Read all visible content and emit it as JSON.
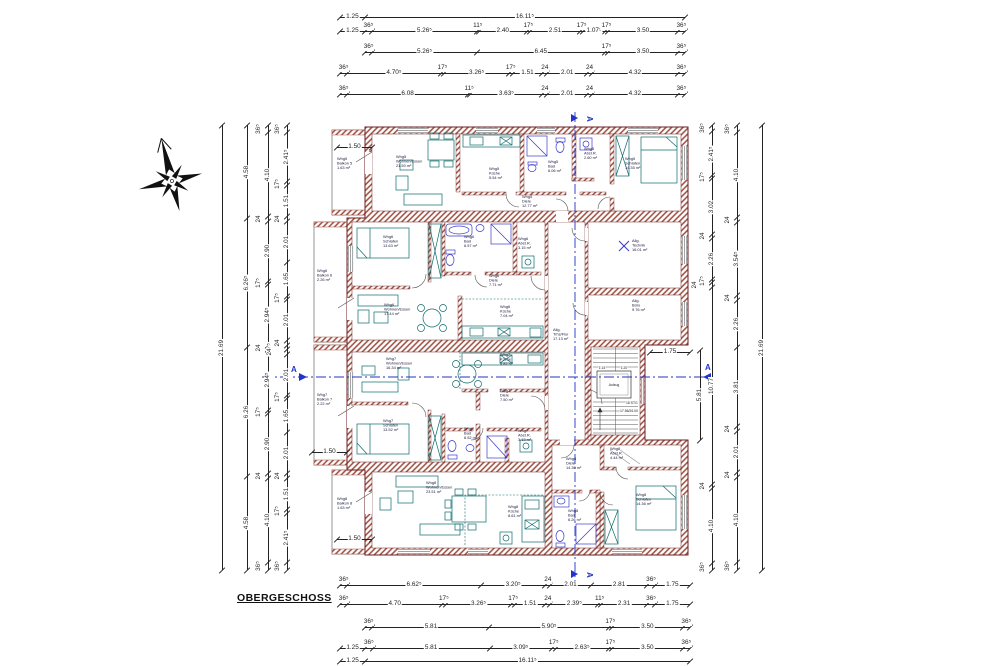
{
  "title": "OBERGESCHOSS",
  "palette": {
    "wall_hatch": "#9a4a3c",
    "wall_line": "#6e2222",
    "furniture": "#0e6b6b",
    "fixture": "#3a3ac8",
    "section": "#2233cc",
    "dim_text": "#1c1c1c",
    "background": "#ffffff"
  },
  "plan": {
    "section_marker": "A",
    "stair": {
      "elevator": "Aufzug",
      "steps": "18 STG",
      "step_dim": "17.56/26.00",
      "width_a": "1.14",
      "width_b": "1.20"
    },
    "rooms": [
      {
        "apt": "Whg5",
        "name": "Wohnen/Essen",
        "area": "21.50 m²"
      },
      {
        "apt": "Whg5",
        "name": "Küche",
        "area": "5.54 m²"
      },
      {
        "apt": "Whg5",
        "name": "Bad",
        "area": "6.06 m²"
      },
      {
        "apt": "Whg5",
        "name": "Abst.R.",
        "area": "2.60 m²"
      },
      {
        "apt": "Whg5",
        "name": "Schlafen",
        "area": "14.35 m²"
      },
      {
        "apt": "Whg5",
        "name": "Diele",
        "area": "12.77 m²"
      },
      {
        "apt": "Whg5",
        "name": "Balkon 5",
        "area": "1.63 m²"
      },
      {
        "apt": "Whg6",
        "name": "Schlafen",
        "area": "13.63 m²"
      },
      {
        "apt": "Whg6",
        "name": "Bad",
        "area": "6.57 m²"
      },
      {
        "apt": "Whg6",
        "name": "Abst.R.",
        "area": "3.15 m²"
      },
      {
        "apt": "Whg6",
        "name": "Diele",
        "area": "7.71 m²"
      },
      {
        "apt": "Whg6",
        "name": "Wohnen/Essen",
        "area": "17.44 m²"
      },
      {
        "apt": "Whg6",
        "name": "Küche",
        "area": "7.04 m²"
      },
      {
        "apt": "Whg6",
        "name": "Balkon 6",
        "area": "2.26 m²"
      },
      {
        "apt": "Whg7",
        "name": "Wohnen/Essen",
        "area": "16.34 m²"
      },
      {
        "apt": "Whg7",
        "name": "Küche",
        "area": "6.82 m²"
      },
      {
        "apt": "Whg7",
        "name": "Diele",
        "area": "7.50 m²"
      },
      {
        "apt": "Whg7",
        "name": "Schlafen",
        "area": "13.52 m²"
      },
      {
        "apt": "Whg7",
        "name": "Bad",
        "area": "6.52 m²"
      },
      {
        "apt": "Whg7",
        "name": "Abst.R.",
        "area": "3.13 m²"
      },
      {
        "apt": "Whg7",
        "name": "Balkon 7",
        "area": "2.22 m²"
      },
      {
        "apt": "Whg8",
        "name": "Wohnen/Essen",
        "area": "23.51 m²"
      },
      {
        "apt": "Whg8",
        "name": "Küche",
        "area": "8.61 m²"
      },
      {
        "apt": "Whg8",
        "name": "Balkon 8",
        "area": "1.63 m²"
      },
      {
        "apt": "Whg8",
        "name": "Abst.R.",
        "area": "4.44 m²"
      },
      {
        "apt": "Whg8",
        "name": "Diele",
        "area": "14.30 m²"
      },
      {
        "apt": "Whg8",
        "name": "Bad",
        "area": "6.26 m²"
      },
      {
        "apt": "Whg8",
        "name": "Schlafen",
        "area": "14.36 m²"
      },
      {
        "apt": "Allg.",
        "name": "Technik",
        "area": "16.01 m²"
      },
      {
        "apt": "Allg.",
        "name": "Büro",
        "area": "9.76 m²"
      },
      {
        "apt": "Allg.",
        "name": "Trhs/Flur",
        "area": "17.13 m²"
      }
    ]
  },
  "dims": {
    "top": [
      [
        "1.25",
        "16.11⁵"
      ],
      [
        "1.25",
        "36⁵",
        "5.26⁵",
        "11⁵",
        "2.40",
        "17⁵",
        "2.51",
        "17⁵",
        "1.07⁵",
        "17⁵",
        "3.50",
        "36⁵"
      ],
      [
        "36⁵",
        "5.26⁵",
        "6.45",
        "17⁵",
        "3.50",
        "36⁵"
      ],
      [
        "36⁵",
        "4.70⁵",
        "17⁵",
        "3.26⁵",
        "17⁵",
        "1.51",
        "24",
        "2.01",
        "24",
        "4.32",
        "36⁵"
      ],
      [
        "36⁵",
        "6.08",
        "11⁵",
        "3.63⁵",
        "24",
        "2.01",
        "24",
        "4.32",
        "36⁵"
      ]
    ],
    "bottom": [
      [
        "36⁵",
        "6.62⁵",
        "3.20⁵",
        "24",
        "2.01",
        "2.81",
        "36⁵",
        "1.75"
      ],
      [
        "36⁵",
        "4.70",
        "17⁵",
        "3.26⁵",
        "17⁵",
        "1.51",
        "24",
        "2.39⁵",
        "11⁵",
        "2.31",
        "36⁵",
        "1.75"
      ],
      [
        "36⁵",
        "5.81",
        "5.90⁵",
        "17⁵",
        "3.50",
        "36⁵"
      ],
      [
        "1.25",
        "36⁵",
        "5.81",
        "3.09⁵",
        "17⁵",
        "2.63⁵",
        "17⁵",
        "3.50",
        "36⁵"
      ],
      [
        "1.25",
        "16.11⁵"
      ]
    ],
    "left": [
      [
        "21.69"
      ],
      [
        "4.58",
        "6.26⁵",
        "6.26",
        "4.58"
      ],
      [
        "36⁵",
        "4.10",
        "24",
        "2.90",
        "17⁵",
        "2.94⁵",
        "24",
        "2.94⁵",
        "17⁵",
        "2.90",
        "24",
        "4.10",
        "36⁵"
      ],
      [
        "36⁵",
        "2.41⁵",
        "17⁵",
        "1.51",
        "24",
        "2.01",
        "1.65",
        "17⁵",
        "2.01",
        "24",
        "17⁵",
        "24",
        "2.01",
        "17⁵",
        "1.65",
        "2.01",
        "24",
        "1.51",
        "17⁵",
        "2.41⁵",
        "36⁵"
      ]
    ],
    "right": [
      [
        "36⁵",
        "2.41⁵",
        "17⁵",
        "3.02",
        "24",
        "2.26",
        "17⁵",
        "24",
        "10.77",
        "24",
        "4.10",
        "36⁵"
      ],
      [
        "36⁵",
        "4.10",
        "24",
        "3.54⁵",
        "24",
        "2.26",
        "3.81",
        "24",
        "2.01",
        "24",
        "4.10",
        "36⁵"
      ],
      [
        "21.69"
      ]
    ],
    "standalone": {
      "balcony5": [
        "1.50"
      ],
      "balcony7": [
        "1.50"
      ],
      "balcony8": [
        "1.50"
      ],
      "notch": [
        "1.75"
      ],
      "notch_v": [
        "5.81"
      ]
    }
  }
}
